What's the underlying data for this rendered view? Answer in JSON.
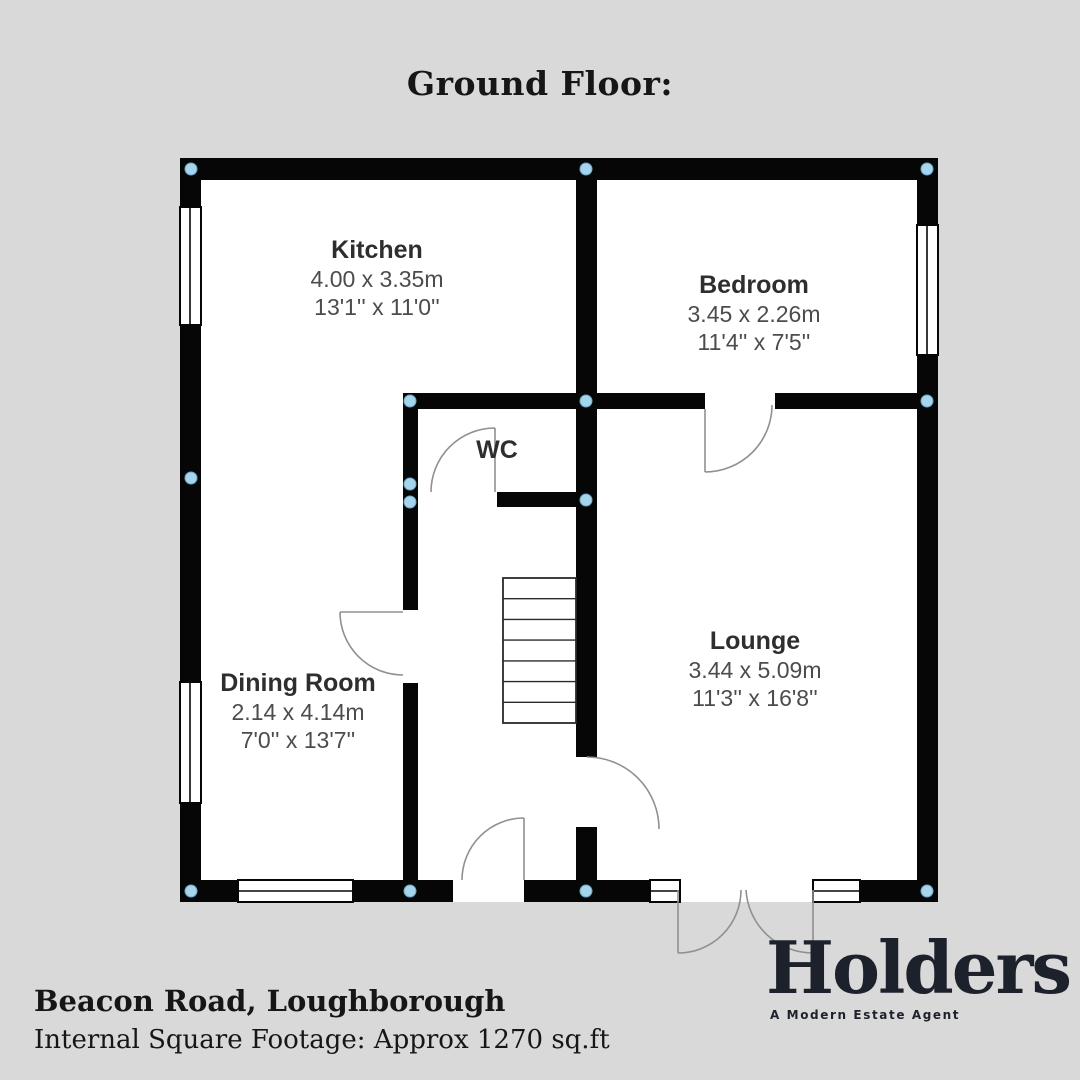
{
  "title": "Ground Floor:",
  "plan": {
    "rooms": [
      {
        "name": "Kitchen",
        "metric": "4.00 x 3.35m",
        "imperial": "13'1'' x 11'0''"
      },
      {
        "name": "Bedroom",
        "metric": "3.45 x 2.26m",
        "imperial": "11'4'' x 7'5''"
      },
      {
        "name": "Dining Room",
        "metric": "2.14 x 4.14m",
        "imperial": "7'0'' x 13'7''"
      },
      {
        "name": "Lounge",
        "metric": "3.44 x 5.09m",
        "imperial": "11'3'' x 16'8''"
      },
      {
        "name": "WC"
      }
    ]
  },
  "footer": {
    "address": "Beacon Road, Loughborough",
    "footage": "Internal Square Footage: Approx 1270 sq.ft"
  },
  "logo": {
    "word": "Holders",
    "tagline": "A Modern Estate Agent"
  },
  "colors": {
    "bg": "#d9d9d9",
    "wall": "#060606",
    "door": "#909090",
    "node": "#a6d4ea",
    "logo-ink": "#1d212c"
  }
}
